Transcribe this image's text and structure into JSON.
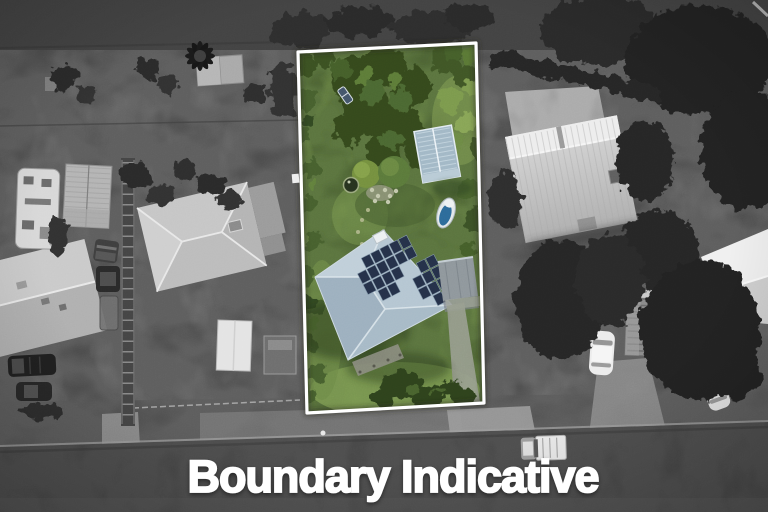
{
  "caption": {
    "text": "Boundary Indicative"
  },
  "colors": {
    "caption_text": "#ffffff",
    "boundary_line": "#ffffff",
    "surroundings_gray": "#5e5e5e",
    "road_gray": "#4e4e4e",
    "property_grass": "#5b743f",
    "property_lawn_light": "#7d9a52",
    "garden_tree_green": "#35491e",
    "house_roof_blue_gray": "#b5c6d2",
    "solar_panel_dark": "#253149",
    "greenhouse_pale_blue": "#a2b8c6",
    "neighbor_roof_gray": "#c6c6c6",
    "barn_roof_light": "#ededed"
  },
  "scene": {
    "objects": [
      "highlighted-property-lot",
      "main-house-hip-roof",
      "rooftop-solar-panels",
      "greenhouse",
      "garden-trees",
      "small-boat",
      "pond",
      "neighbor-house",
      "caravan",
      "carport-shed",
      "barn-shed",
      "timber-shack",
      "parked-cars",
      "street-road",
      "white-ute-on-road",
      "footpath"
    ]
  }
}
